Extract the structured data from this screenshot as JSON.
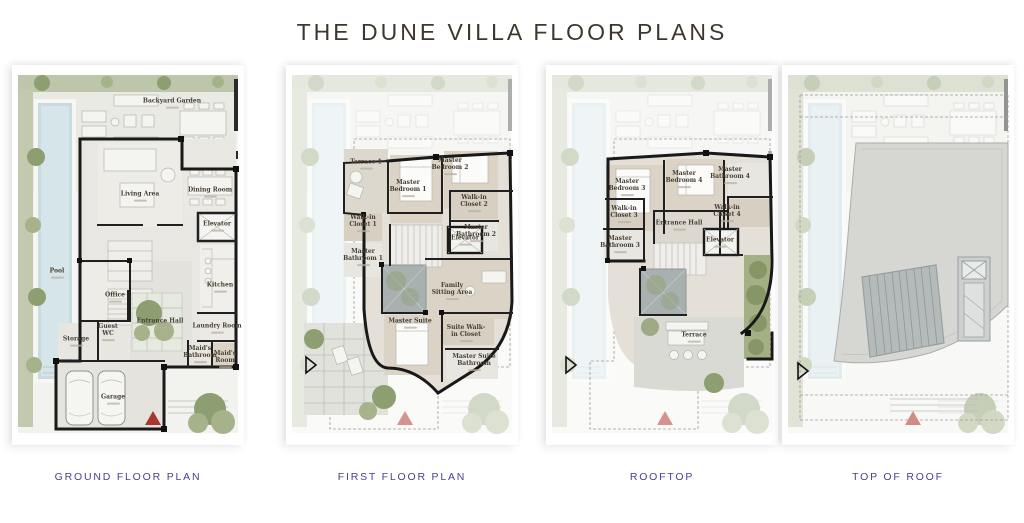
{
  "title": "THE DUNE VILLA FLOOR PLANS",
  "colors": {
    "accent_purple": "#4b4093",
    "wall_black": "#191919",
    "garden_green": "#bdc5aa",
    "pool_blue": "#c7dbe1",
    "roof_gray": "#d6d6d2",
    "marker_red": "#a9362f",
    "marker_pink": "#d6928d",
    "title_color": "#3e372e"
  },
  "markers": {
    "entrance_marker": "red-triangle",
    "direction_arrow": "black-outline-triangle"
  },
  "panels": [
    {
      "caption": "GROUND FLOOR PLAN",
      "rooms": [
        {
          "label": "Backyard Garden"
        },
        {
          "label": "Pool"
        },
        {
          "label": "Living Area"
        },
        {
          "label": "Dining Room"
        },
        {
          "label": "Elevator"
        },
        {
          "label": "Kitchen"
        },
        {
          "label": "Office"
        },
        {
          "label": "Entrance Hall"
        },
        {
          "label": "Laundry Room"
        },
        {
          "label": "Guest WC"
        },
        {
          "label": "Storage"
        },
        {
          "label": "Maid's Bathroom"
        },
        {
          "label": "Maid's Room"
        },
        {
          "label": "Garage"
        }
      ]
    },
    {
      "caption": "FIRST FLOOR PLAN",
      "rooms": [
        {
          "label": "Terrace 1"
        },
        {
          "label": "Master Bedroom 1"
        },
        {
          "label": "Master Bedroom 2"
        },
        {
          "label": "Walk-in Closet 1"
        },
        {
          "label": "Walk-in Closet 2"
        },
        {
          "label": "Master Bathroom 2"
        },
        {
          "label": "Master Bathroom 1"
        },
        {
          "label": "Elevator"
        },
        {
          "label": "Family Sitting Area"
        },
        {
          "label": "Master Suite"
        },
        {
          "label": "Suite Walk-in Closet"
        },
        {
          "label": "Master Suite Bathroom"
        }
      ]
    },
    {
      "caption": "ROOFTOP",
      "rooms": [
        {
          "label": "Master Bedroom 3"
        },
        {
          "label": "Master Bedroom 4"
        },
        {
          "label": "Master Bathroom 4"
        },
        {
          "label": "Walk-in Closet 4"
        },
        {
          "label": "Walk-in Closet 3"
        },
        {
          "label": "Master Bathroom 3"
        },
        {
          "label": "Entrance Hall"
        },
        {
          "label": "Elevator"
        },
        {
          "label": "Terrace"
        }
      ]
    },
    {
      "caption": "TOP OF ROOF",
      "rooms": []
    }
  ]
}
